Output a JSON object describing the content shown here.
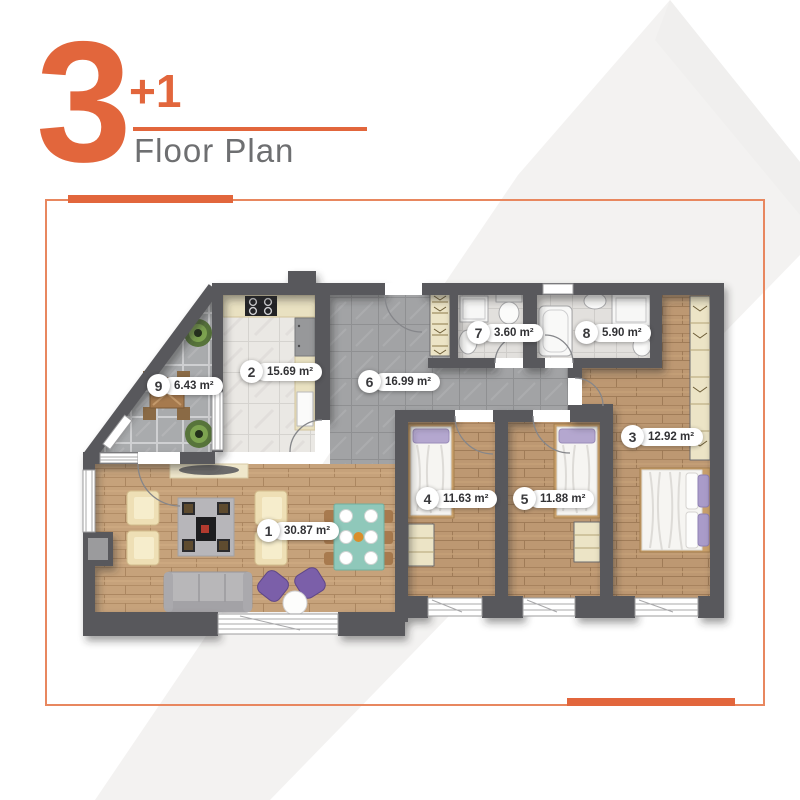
{
  "title": {
    "big_number": "3",
    "plus_number": "+1",
    "subtitle": "Floor Plan"
  },
  "colors": {
    "accent_orange": "#e2663c",
    "frame_orange": "#e8875f",
    "subtitle_gray": "#6e6f71",
    "wall_gray": "#58585b",
    "wood_floor": "#c6a27b",
    "hall_tile": "#a2a3a5",
    "terrace_tile": "#a9abad",
    "kitchen_marble": "#eae8e4",
    "label_text": "#323235",
    "watermark_gray": "#f3f2f1"
  },
  "rooms": [
    {
      "id": "1",
      "area": "30.87 m²",
      "name": "living-room"
    },
    {
      "id": "2",
      "area": "15.69 m²",
      "name": "kitchen"
    },
    {
      "id": "3",
      "area": "12.92 m²",
      "name": "bedroom-main"
    },
    {
      "id": "4",
      "area": "11.63 m²",
      "name": "bedroom-left"
    },
    {
      "id": "5",
      "area": "11.88 m²",
      "name": "bedroom-middle"
    },
    {
      "id": "6",
      "area": "16.99 m²",
      "name": "hall"
    },
    {
      "id": "7",
      "area": "3.60 m²",
      "name": "bathroom-small"
    },
    {
      "id": "8",
      "area": "5.90 m²",
      "name": "bathroom-large"
    },
    {
      "id": "9",
      "area": "6.43 m²",
      "name": "terrace"
    }
  ]
}
